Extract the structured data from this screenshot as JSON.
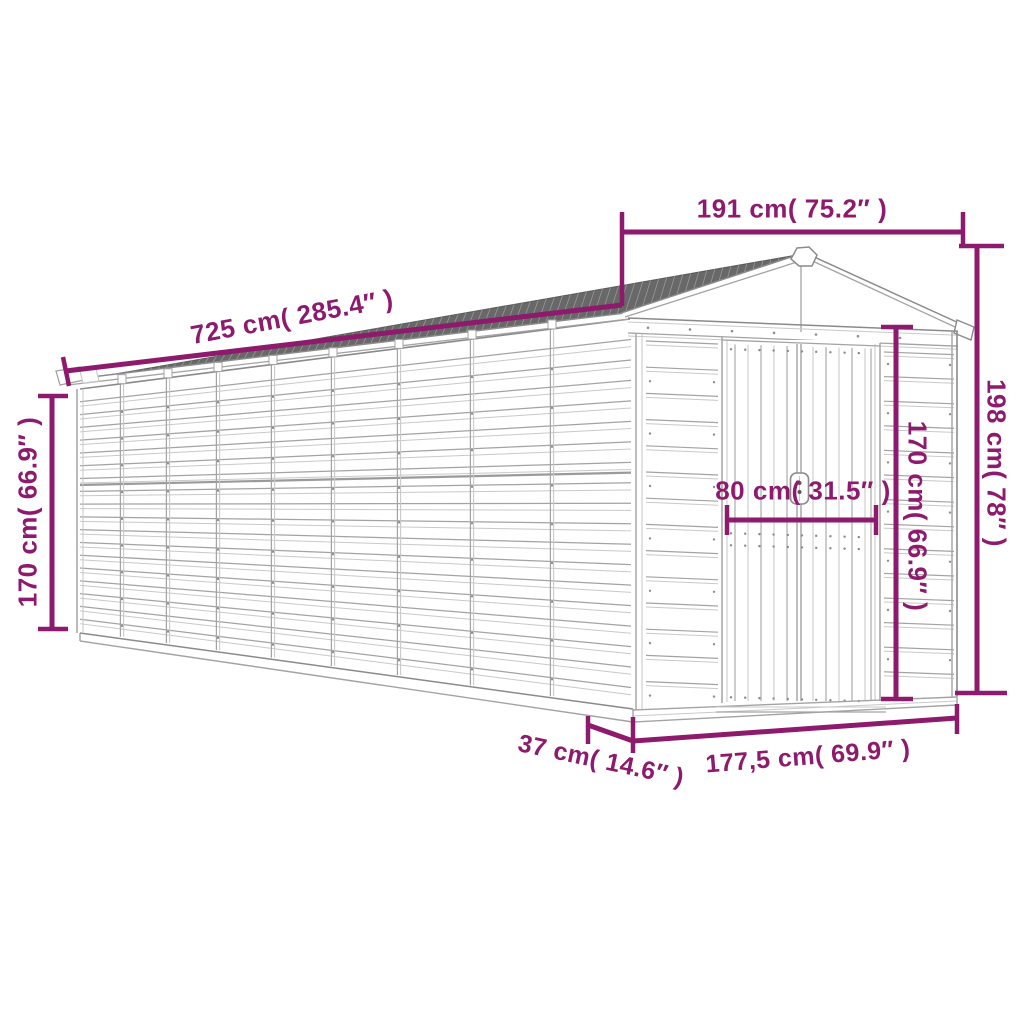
{
  "image_type": "product-dimension-diagram",
  "drawing": {
    "subject": "garden-shed-line-drawing",
    "background_color": "#ffffff",
    "line_color": "#a3a3a3",
    "line_color_dark": "#8a8a8a",
    "line_color_light": "#c9c9c9",
    "roof_color": "#686868",
    "roof_hatch_color": "#989898",
    "vent_slat_color": "#4f4f4f"
  },
  "accent_color": "#8d1a6d",
  "dimension_labels": {
    "roof_length": "725 cm( 285.4″ )",
    "top_width": "191 cm( 75.2″ )",
    "left_height": "170 cm( 66.9″ )",
    "right_height": "198 cm( 78″ )",
    "door_width": "80 cm( 31.5″ )",
    "door_height": "170 cm( 66.9″ )",
    "base_depth": "37 cm( 14.6″ )",
    "base_width": "177,5 cm( 69.9″ )"
  }
}
